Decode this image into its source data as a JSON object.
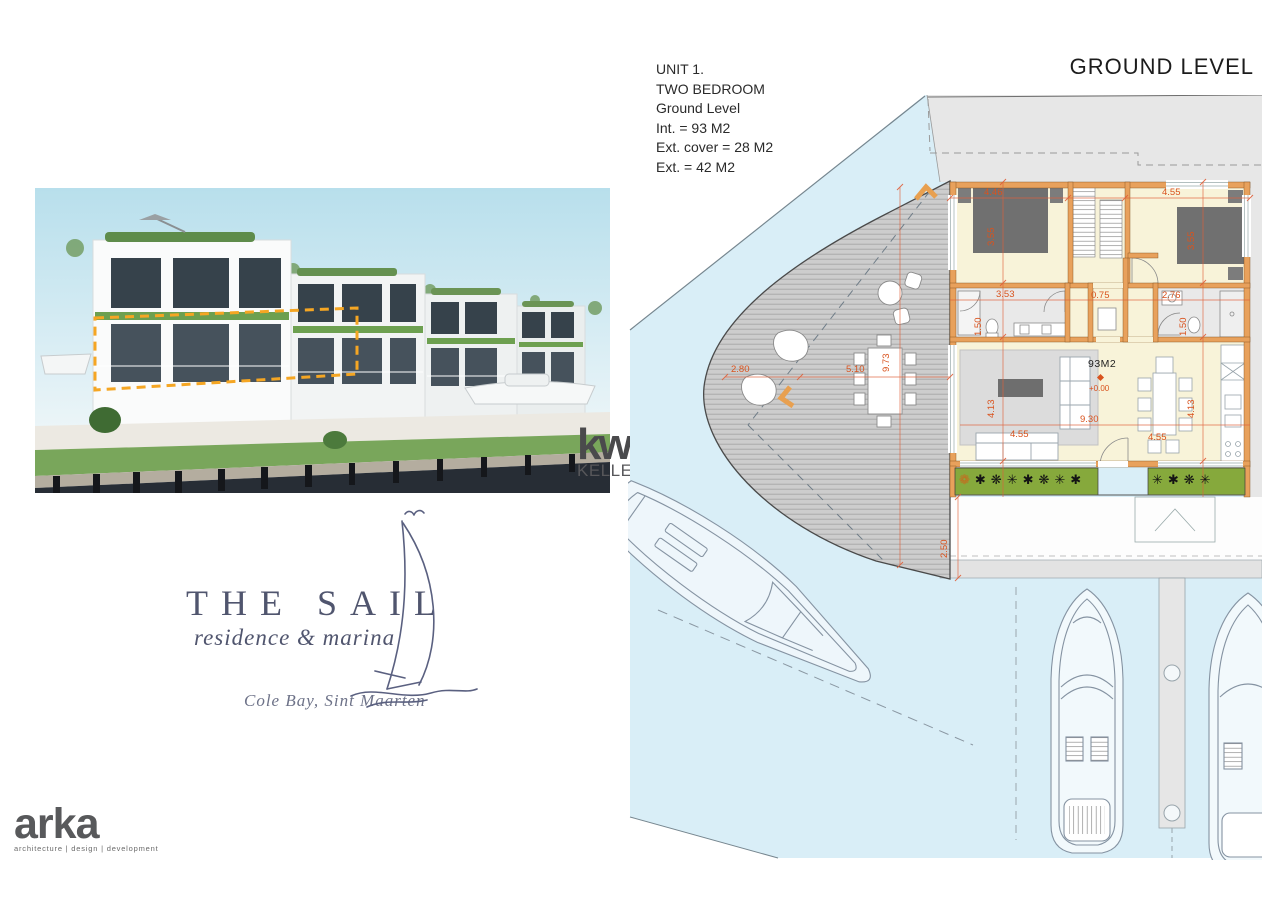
{
  "header": {
    "title": "GROUND LEVEL"
  },
  "unit_info": {
    "lines": [
      "UNIT 1.",
      "TWO BEDROOM",
      "Ground Level",
      "Int. = 93 M2",
      "Ext. cover = 28 M2",
      "Ext. = 42 M2"
    ]
  },
  "floor_plan": {
    "area_label": "93M2",
    "level_label": "+0.00",
    "dims": {
      "bed1_w": "4.46",
      "bed1_d": "3.55",
      "bed2_w": "4.55",
      "bed2_d": "3.55",
      "bath1_w": "3.53",
      "bath1_d": "1.50",
      "hall_w": "0.75",
      "bath2_w": "2.76",
      "bath2_d": "1.50",
      "living_d": "4.13",
      "living_w": "9.30",
      "sofa_w": "4.55",
      "kitchen_d": "4.13",
      "kitchen_w": "4.55",
      "deck_d": "9.73",
      "deck_w_outer": "2.80",
      "deck_w_inner": "5.10",
      "quay_d": "2.50"
    },
    "planter_left": "✱❋✳✱❋✳✱",
    "planter_right": "✳✱❋✳",
    "planter_flower": "❁"
  },
  "branding": {
    "kw": {
      "mark": "kw",
      "region_line1": "SINT",
      "region_line2": "MAARTEN",
      "company": "KELLERWILLIAMS."
    },
    "sail": {
      "name": "THE SAIL",
      "tagline": "residence & marina",
      "location": "Cole Bay, Sint Maarten"
    },
    "arka": {
      "name": "arka",
      "tagline": "architecture | design | development"
    }
  },
  "colors": {
    "water": "#d9eef7",
    "deck": "#cdcdcd",
    "wall": "#e8a15c",
    "room_fill": "#f8f3d9",
    "dimension_text": "#d9531e",
    "planter_green": "#86a93c",
    "slab_gray": "#e7e7e7",
    "unit_outline_orange": "#f5a623",
    "logo_blue": "#50556e"
  }
}
